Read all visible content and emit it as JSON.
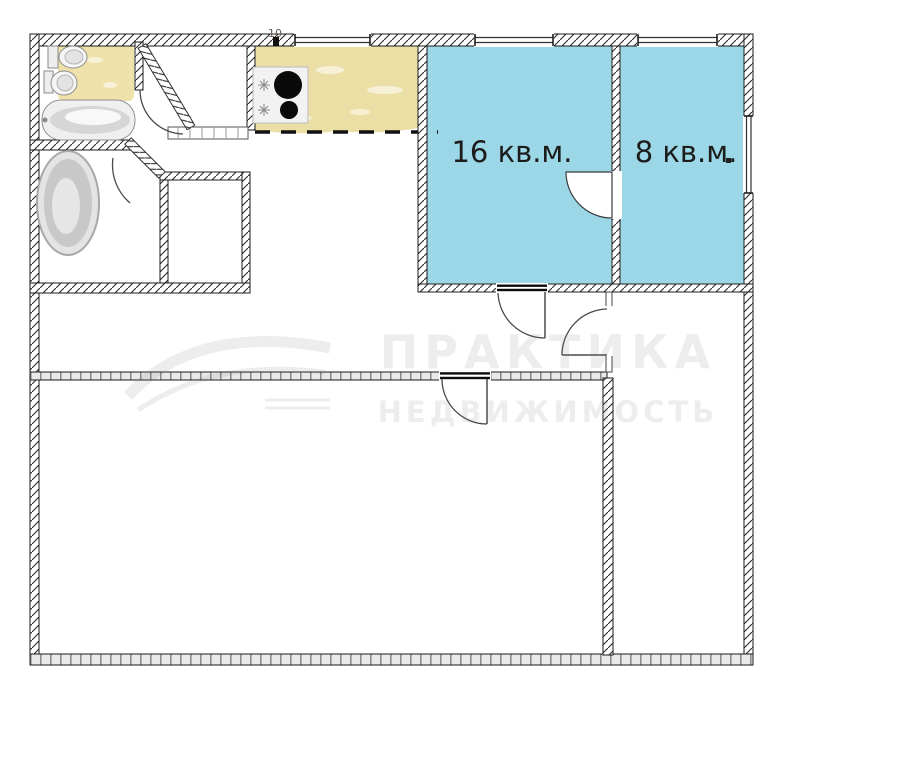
{
  "floor_plan": {
    "type": "apartment-floor-plan",
    "rooms": [
      {
        "name": "room-16",
        "area_label": "16 кв.м."
      },
      {
        "name": "room-8",
        "area_label": "8 кв.м."
      }
    ],
    "riser_label": "10",
    "watermark": {
      "brand": "ПРАКТИКА",
      "subtitle": "НЕДВИЖИМОСТЬ"
    },
    "colors": {
      "room_fill": "#9bd7e6",
      "kitchen_tile": "#ecdfa6",
      "bathroom_tile": "#eee1a9",
      "wall_ink": "#1b1b1b",
      "masonry": "#e9e9e9",
      "door_ink": "#4a4a4a",
      "watermark_ink": "#7a7a7a"
    }
  }
}
